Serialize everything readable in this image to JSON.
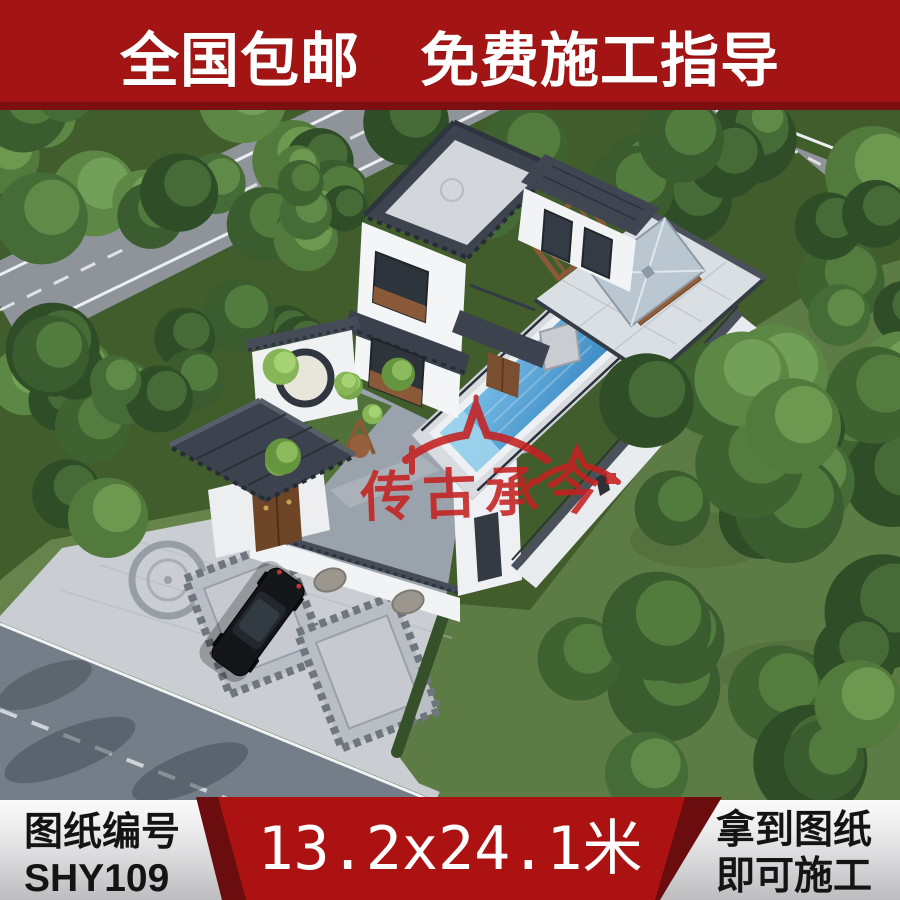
{
  "top_banner": {
    "text": "全国包邮　免费施工指导",
    "background": "#a31514",
    "bottom_strip": "#7c0f0f",
    "text_color": "#ffffff"
  },
  "watermark": {
    "icon": "chinese-roof-watermark-icon",
    "text": "传古承今",
    "color": "#c52121"
  },
  "scene_palette": {
    "tree_green": "#3a5c2e",
    "grass": "#5d7b44",
    "road_upper": "#8f949b",
    "road_lower": "#747e88",
    "paving": "#cacdd2",
    "wall_white": "#f2f3f5",
    "roof_slate": "#3d444f",
    "pool_water": "#4f9fd4",
    "wood_brown": "#8a5a38",
    "car_black": "#141619"
  },
  "bottom_banner": {
    "background_top": "#fbfbfb",
    "background_bottom": "#bdbdbf",
    "text_color": "#141414",
    "left": {
      "line1": "图纸编号",
      "line2": "SHY109"
    },
    "center": {
      "text": "13.2x24.1米",
      "background": "#ad1212",
      "edge_color": "#6b0c0e",
      "text_color": "#ffffff"
    },
    "right": {
      "line1": "拿到图纸",
      "line2": "即可施工"
    }
  }
}
